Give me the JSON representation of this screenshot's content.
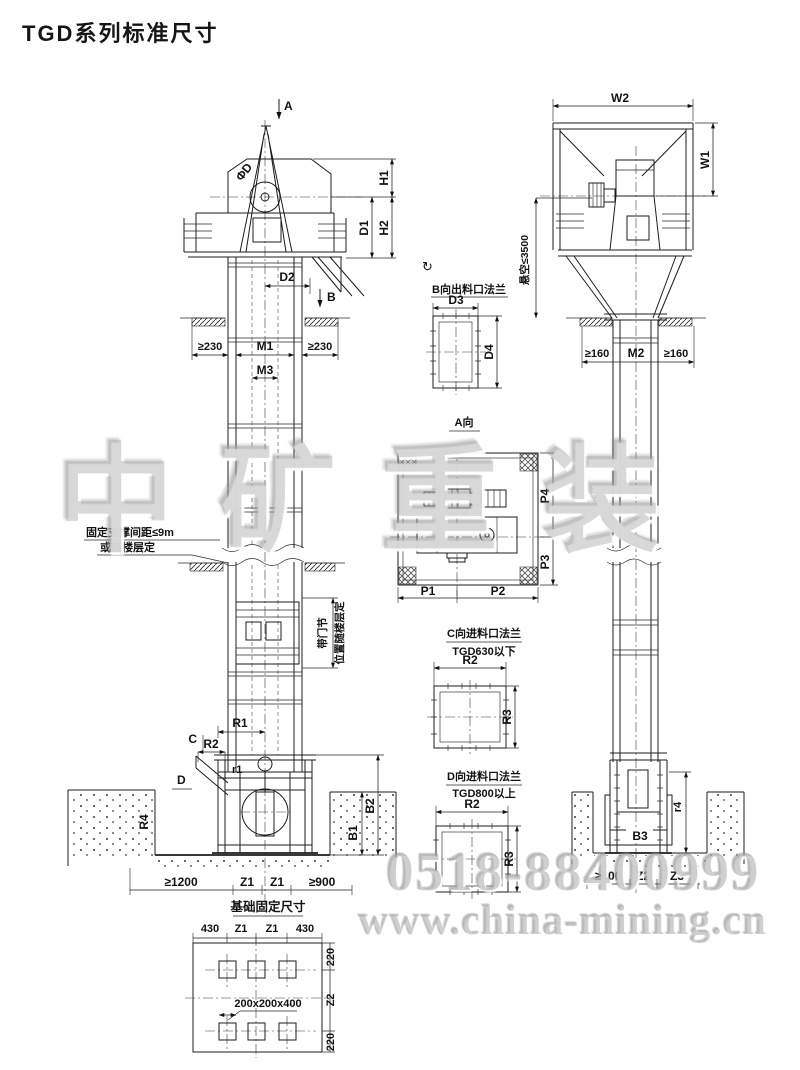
{
  "page": {
    "title": "TGD系列标准尺寸"
  },
  "watermark": {
    "brand": "中矿重装",
    "phone": "0518-88400999",
    "url": "www.china-mining.cn"
  },
  "lv": {
    "a": "A",
    "b": "B",
    "c": "C",
    "d": "D",
    "phid": "ΦD",
    "h1": "H1",
    "h2": "H2",
    "d1": "D1",
    "d2": "D2",
    "m1": "M1",
    "m3": "M3",
    "gte230l": "≥230",
    "gte230r": "≥230",
    "support1": "固定支撑间距≤9m",
    "support2": "或随楼层定",
    "door1": "带门节",
    "door2": "位置随楼层定",
    "r1": "R1",
    "r2": "R2",
    "r1s": "r1",
    "r4": "R4",
    "b1": "B1",
    "b2": "B2",
    "gte1200": "≥1200",
    "z1a": "Z1",
    "z1b": "Z1",
    "gte900": "≥900"
  },
  "fd": {
    "title": "基础固定尺寸",
    "d430a": "430",
    "z1a": "Z1",
    "z1b": "Z1",
    "d430b": "430",
    "hole": "200x200x400",
    "d220a": "220",
    "z2": "Z2",
    "d220b": "220"
  },
  "dt": {
    "rot": "↻",
    "bt": "B向出料口法兰",
    "d3": "D3",
    "d4": "D4",
    "at": "A向",
    "p1": "P1",
    "p2": "P2",
    "p3": "P3",
    "p4": "P4",
    "ct": "C向进料口法兰",
    "cs": "TGD630以下",
    "cr2": "R2",
    "cr3": "R3",
    "dtt": "D向进料口法兰",
    "ds": "TGD800以上",
    "dr2": "R2",
    "dr3": "R3"
  },
  "rv": {
    "w1": "W1",
    "w2": "W2",
    "m2": "M2",
    "gte160l": "≥160",
    "gte160r": "≥160",
    "susp": "悬空≤3500",
    "b3": "B3",
    "r4": "r4",
    "gte800": "≥800",
    "z2": "Z2",
    "z3": "Z3"
  }
}
